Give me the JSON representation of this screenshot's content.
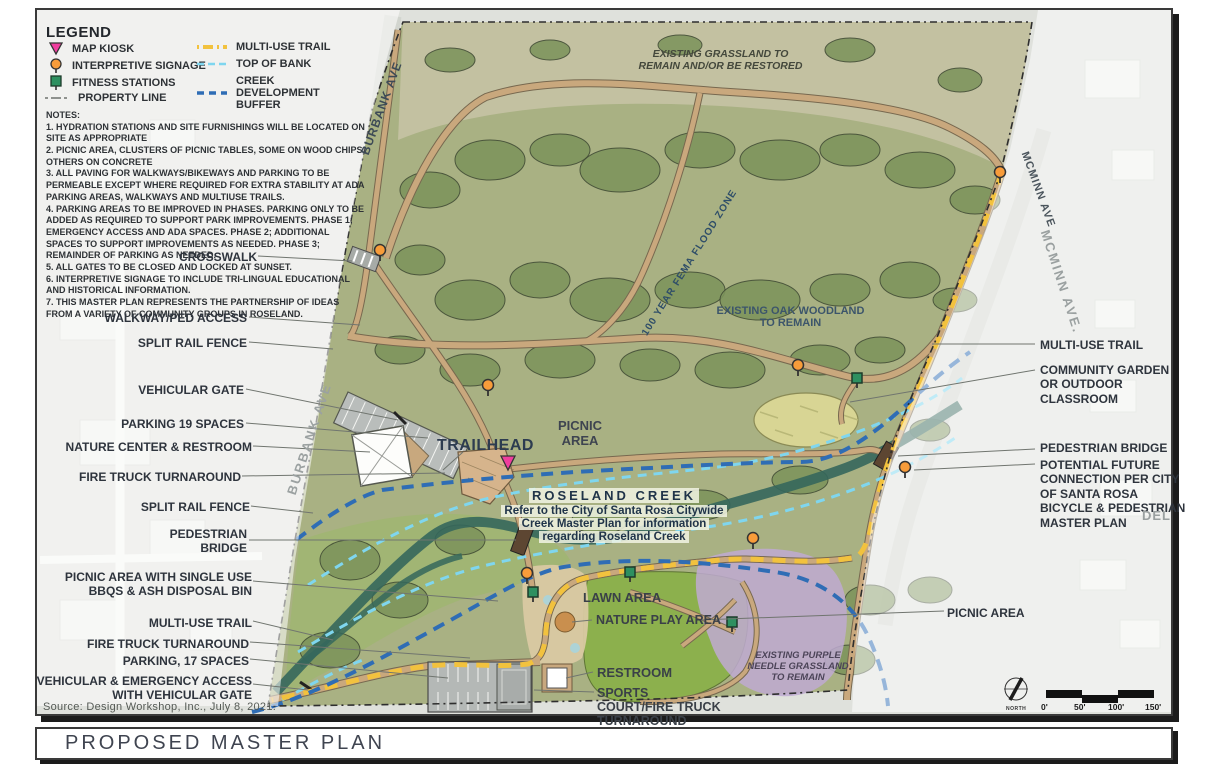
{
  "legend": {
    "title": "LEGEND",
    "point_items": [
      {
        "icon": "map-kiosk-icon",
        "label": "MAP KIOSK"
      },
      {
        "icon": "interpretive-signage-icon",
        "label": "INTERPRETIVE SIGNAGE"
      },
      {
        "icon": "fitness-stations-icon",
        "label": "FITNESS STATIONS"
      },
      {
        "icon": "property-line-icon",
        "label": "PROPERTY LINE"
      }
    ],
    "line_items": [
      {
        "icon": "multi-use-trail-line",
        "label": "MULTI-USE TRAIL"
      },
      {
        "icon": "top-of-bank-line",
        "label": "TOP OF BANK"
      },
      {
        "icon": "creek-buffer-line",
        "label": "CREEK DEVELOPMENT BUFFER"
      }
    ]
  },
  "notes": {
    "heading": "NOTES:",
    "items": [
      "1. HYDRATION STATIONS AND SITE FURNISHINGS WILL BE LOCATED ON SITE AS APPROPRIATE",
      "2. PICNIC AREA, CLUSTERS OF PICNIC TABLES, SOME ON WOOD CHIPS, OTHERS ON CONCRETE",
      "3. ALL PAVING FOR WALKWAYS/BIKEWAYS AND PARKING TO BE PERMEABLE EXCEPT WHERE REQUIRED FOR EXTRA STABILITY AT ADA PARKING AREAS, WALKWAYS AND MULTIUSE TRAILS.",
      "4. PARKING AREAS TO BE IMPROVED IN PHASES. PARKING ONLY TO BE ADDED AS REQUIRED TO SUPPORT PARK IMPROVEMENTS. PHASE 1; EMERGENCY ACCESS AND ADA SPACES. PHASE 2; ADDITIONAL SPACES TO SUPPORT IMPROVEMENTS AS NEEDED. PHASE 3; REMAINDER OF PARKING AS NEEDED.",
      "5. ALL GATES TO BE CLOSED AND LOCKED AT SUNSET.",
      "6. INTERPRETIVE SIGNAGE TO INCLUDE TRI-LINGUAL EDUCATIONAL AND HISTORICAL INFORMATION.",
      "7. THIS MASTER PLAN REPRESENTS THE PARTNERSHIP OF IDEAS FROM A VARIETY OF COMMUNITY GROUPS IN ROSELAND."
    ]
  },
  "callouts_left": [
    "CROSSWALK",
    "WALKWAY/PED ACCESS",
    "SPLIT RAIL FENCE",
    "VEHICULAR GATE",
    "PARKING 19 SPACES",
    "NATURE CENTER & RESTROOM",
    "FIRE TRUCK TURNAROUND",
    "SPLIT RAIL FENCE",
    "PEDESTRIAN BRIDGE",
    "PICNIC AREA WITH SINGLE USE BBQS & ASH DISPOSAL BIN",
    "MULTI-USE TRAIL",
    "FIRE TRUCK TURNAROUND",
    "PARKING, 17 SPACES",
    "VEHICULAR & EMERGENCY ACCESS WITH VEHICULAR GATE"
  ],
  "callouts_right": [
    "MULTI-USE TRAIL",
    "COMMUNITY GARDEN OR OUTDOOR CLASSROOM",
    "PEDESTRIAN BRIDGE",
    "POTENTIAL FUTURE CONNECTION PER CITY OF SANTA ROSA BICYCLE & PEDESTRIAN MASTER PLAN",
    "PICNIC AREA"
  ],
  "map_labels": {
    "existing_grassland": "EXISTING GRASSLAND TO REMAIN AND/OR BE RESTORED",
    "fema_flood_zone": "100 YEAR FEMA FLOOD ZONE",
    "oak_woodland": "EXISTING OAK WOODLAND TO REMAIN",
    "trailhead": "TRAILHEAD",
    "picnic_area_center": "PICNIC AREA",
    "roseland_creek_title": "ROSELAND CREEK",
    "roseland_creek_note": "Refer to the City of Santa Rosa Citywide Creek Master Plan for information regarding Roseland Creek",
    "lawn_area": "LAWN AREA",
    "nature_play": "NATURE PLAY AREA",
    "restroom": "RESTROOM",
    "sports_court": "SPORTS COURT/FIRE TRUCK TURNAROUND",
    "purple_needle": "EXISTING PURPLE NEEDLE GRASSLAND TO REMAIN",
    "del_street": "DEL"
  },
  "streets": {
    "burbank_top": "BURBANK AVE",
    "burbank_bottom": "BURBANK AVE",
    "mcminn_inner": "MCMINN AVE",
    "mcminn_outer": "MCMINN AVE."
  },
  "scale": {
    "north_label": "NORTH",
    "ticks": [
      "0'",
      "50'",
      "100'",
      "150'"
    ]
  },
  "source": "Source: Design Workshop, Inc., July 8, 2021.",
  "title_bar": {
    "title": "PROPOSED MASTER PLAN"
  },
  "colors": {
    "trail_yellow": "#F2C23E",
    "top_of_bank": "#7FD6EF",
    "creek_buffer": "#2F6DB5",
    "kiosk_pink": "#F03E9E",
    "signage_orange": "#F89C3A",
    "fitness_green": "#2E9060",
    "property_line": "#6f736f"
  }
}
